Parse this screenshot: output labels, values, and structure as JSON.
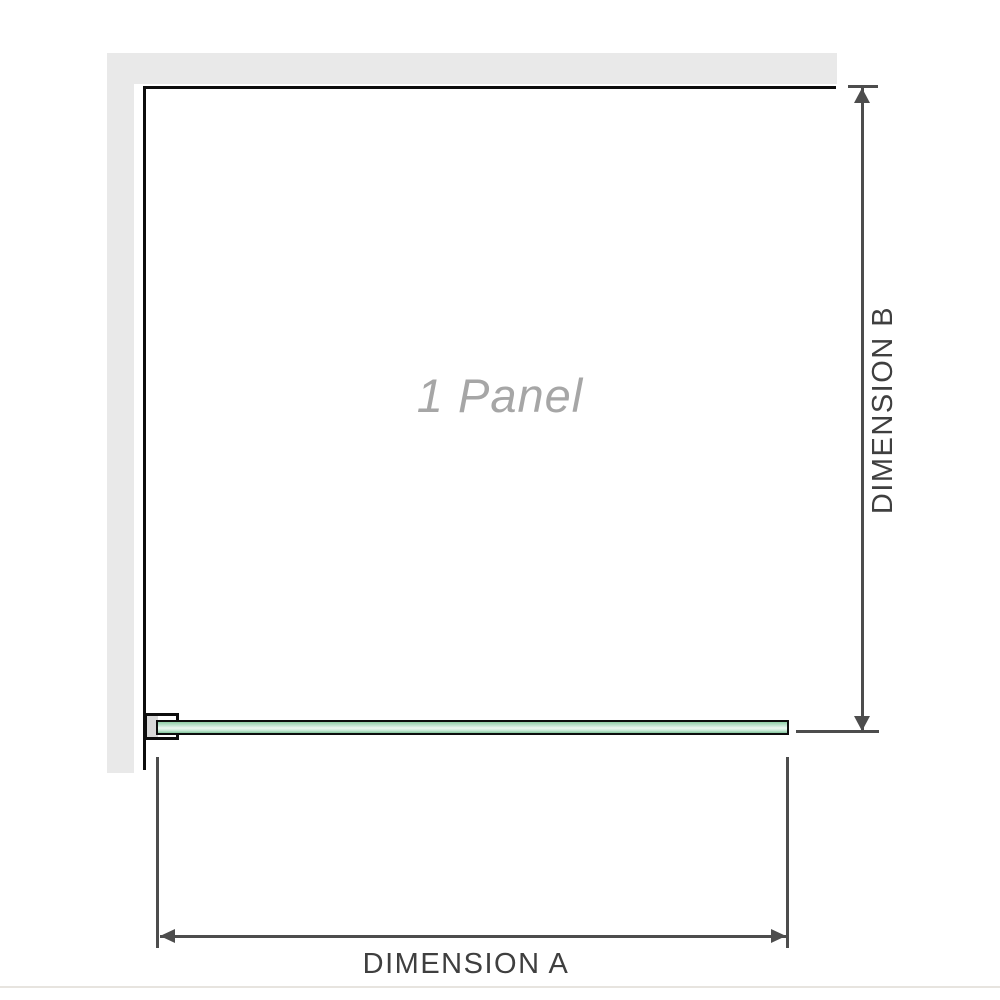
{
  "diagram": {
    "panel_label": "1 Panel",
    "dimension_a_label": "DIMENSION A",
    "dimension_b_label": "DIMENSION B"
  },
  "icons": {
    "dimension_b_arrow_up": "arrow-up",
    "dimension_b_arrow_down": "arrow-down",
    "dimension_a_arrow_left": "arrow-left",
    "dimension_a_arrow_right": "arrow-right"
  },
  "colors": {
    "background": "#ffffff",
    "wall": "#e9e9e9",
    "edge": "#0d0d0d",
    "dimension": "#4d4d4d",
    "dimension_text": "#3f3f3f",
    "panel_label_text": "#a6a6a6",
    "glass_top": "#8fcfa6",
    "glass_light": "#eef9f2",
    "glass_bottom": "#83c79c",
    "clamp_fill": "#d8d8d8",
    "baseline": "#e7e4df"
  }
}
